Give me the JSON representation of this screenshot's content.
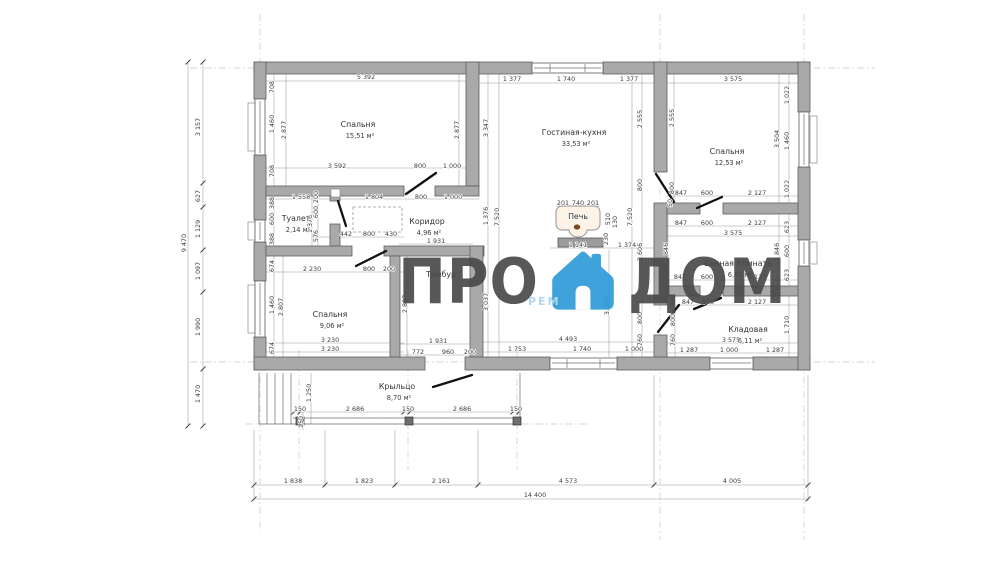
{
  "watermark": {
    "left": "ПРО",
    "right": "ДОМ",
    "sub": "РЕМ"
  },
  "colors": {
    "wall_fill": "#a9a9a9",
    "wall_stroke": "#5e5e5e",
    "accent_blue": "#2f9bd8",
    "text": "#3c3c3c",
    "watermark_grey": "#4a4a4a",
    "stove_dot": "#7a4a21"
  },
  "plan": {
    "rooms": [
      {
        "name": "Спальня",
        "area": "15,51 м²",
        "x": 358,
        "y": 127
      },
      {
        "name": "Гостиная-кухня",
        "area": "33,53 м²",
        "x": 574,
        "y": 135
      },
      {
        "name": "Спальня",
        "area": "12,53 м²",
        "x": 727,
        "y": 154
      },
      {
        "name": "Туалет",
        "area": "2,14 м²",
        "x": 296,
        "y": 221,
        "fs": 7
      },
      {
        "name": "Коридор",
        "area": "4,96 м²",
        "x": 427,
        "y": 224
      },
      {
        "name": "Тамбур",
        "area": "",
        "x": 441,
        "y": 277,
        "fs": 6.6,
        "muted": true
      },
      {
        "name": "Ванная Комната",
        "area": "6,60 м²",
        "x": 738,
        "y": 266
      },
      {
        "name": "Спальня",
        "area": "9,06 м²",
        "x": 330,
        "y": 317
      },
      {
        "name": "Кладовая",
        "area": "6,11 м²",
        "x": 748,
        "y": 332
      },
      {
        "name": "Крыльцо",
        "area": "8,70 м²",
        "x": 397,
        "y": 389
      },
      {
        "name": "Печь",
        "area": "",
        "x": 578,
        "y": 219,
        "fs": 6.2
      }
    ],
    "dims_h": [
      [
        "5 392",
        366,
        79
      ],
      [
        "1 377",
        512,
        81
      ],
      [
        "1 740",
        566,
        81
      ],
      [
        "1 377",
        629,
        81
      ],
      [
        "3 575",
        733,
        81
      ],
      [
        "3 592",
        337,
        168
      ],
      [
        "800",
        420,
        168
      ],
      [
        "1 000",
        452,
        168
      ],
      [
        "1 558",
        301,
        199
      ],
      [
        "1 804",
        374,
        199
      ],
      [
        "800",
        421,
        199
      ],
      [
        "1 000",
        453,
        199
      ],
      [
        "442",
        346,
        236
      ],
      [
        "800",
        369,
        236
      ],
      [
        "430",
        391,
        236
      ],
      [
        "1 931",
        436,
        243
      ],
      [
        "201",
        563,
        205
      ],
      [
        "740",
        578,
        205
      ],
      [
        "201",
        593,
        205
      ],
      [
        "1 141",
        578,
        247
      ],
      [
        "1 374",
        627,
        247
      ],
      [
        "2 230",
        312,
        271
      ],
      [
        "800",
        369,
        271
      ],
      [
        "200",
        389,
        271
      ],
      [
        "847",
        681,
        195
      ],
      [
        "600",
        707,
        195
      ],
      [
        "2 127",
        757,
        195
      ],
      [
        "847",
        681,
        225
      ],
      [
        "600",
        707,
        225
      ],
      [
        "2 127",
        757,
        225
      ],
      [
        "3 575",
        733,
        235
      ],
      [
        "847",
        680,
        279
      ],
      [
        "600",
        707,
        279
      ],
      [
        "2 127",
        757,
        279
      ],
      [
        "847",
        688,
        304
      ],
      [
        "600",
        708,
        304
      ],
      [
        "2 127",
        757,
        304
      ],
      [
        "4 493",
        568,
        341
      ],
      [
        "3 230",
        330,
        342
      ],
      [
        "3 230",
        330,
        351
      ],
      [
        "1 931",
        438,
        343
      ],
      [
        "772",
        418,
        354
      ],
      [
        "960",
        448,
        354
      ],
      [
        "200",
        470,
        354
      ],
      [
        "3 575",
        731,
        342
      ],
      [
        "1 287",
        689,
        352
      ],
      [
        "1 000",
        729,
        352
      ],
      [
        "1 287",
        775,
        352
      ],
      [
        "1 753",
        517,
        351
      ],
      [
        "1 740",
        582,
        351
      ],
      [
        "1 000",
        634,
        351
      ],
      [
        "150",
        300,
        411
      ],
      [
        "2 686",
        355,
        411
      ],
      [
        "150",
        408,
        411
      ],
      [
        "2 686",
        462,
        411
      ],
      [
        "150",
        516,
        411
      ],
      [
        "1 838",
        293,
        483
      ],
      [
        "1 823",
        364,
        483
      ],
      [
        "2 161",
        441,
        483
      ],
      [
        "4 573",
        568,
        483
      ],
      [
        "4 005",
        732,
        483
      ],
      [
        "14 400",
        535,
        497
      ]
    ],
    "dims_v": [
      [
        "9 470",
        186,
        243
      ],
      [
        "3 157",
        200,
        127
      ],
      [
        "627",
        200,
        196
      ],
      [
        "1 129",
        200,
        229
      ],
      [
        "1 097",
        200,
        271
      ],
      [
        "1 990",
        200,
        327
      ],
      [
        "1 470",
        200,
        394
      ],
      [
        "708",
        274,
        87
      ],
      [
        "1 460",
        274,
        124
      ],
      [
        "708",
        274,
        171
      ],
      [
        "2 877",
        286,
        130
      ],
      [
        "2 877",
        459,
        130
      ],
      [
        "3 347",
        488,
        128
      ],
      [
        "388",
        274,
        203
      ],
      [
        "600",
        274,
        219
      ],
      [
        "388",
        274,
        239
      ],
      [
        "200",
        318,
        197
      ],
      [
        "600",
        318,
        212
      ],
      [
        "576",
        318,
        236
      ],
      [
        "1 376",
        312,
        224
      ],
      [
        "674",
        274,
        266
      ],
      [
        "1 460",
        274,
        305
      ],
      [
        "674",
        274,
        348
      ],
      [
        "2 807",
        283,
        307
      ],
      [
        "2 807",
        407,
        304
      ],
      [
        "1 376",
        488,
        216
      ],
      [
        "7 520",
        499,
        217
      ],
      [
        "3 037",
        488,
        302
      ],
      [
        "2 555",
        642,
        119
      ],
      [
        "800",
        642,
        185
      ],
      [
        "7 520",
        632,
        217
      ],
      [
        "2 606",
        642,
        252
      ],
      [
        "800",
        642,
        318
      ],
      [
        "760",
        642,
        340
      ],
      [
        "3 066",
        609,
        306
      ],
      [
        "510",
        610,
        219
      ],
      [
        "130",
        617,
        222
      ],
      [
        "230",
        608,
        239
      ],
      [
        "2 555",
        674,
        118
      ],
      [
        "800",
        674,
        188
      ],
      [
        "50",
        672,
        203
      ],
      [
        "1 846",
        668,
        252
      ],
      [
        "50",
        675,
        301
      ],
      [
        "800",
        675,
        320
      ],
      [
        "760",
        675,
        340
      ],
      [
        "1 022",
        789,
        95
      ],
      [
        "3 504",
        779,
        139
      ],
      [
        "1 460",
        789,
        141
      ],
      [
        "1 022",
        789,
        189
      ],
      [
        "623",
        789,
        227
      ],
      [
        "600",
        789,
        251
      ],
      [
        "623",
        789,
        275
      ],
      [
        "1 846",
        779,
        252
      ],
      [
        "1 710",
        789,
        325
      ],
      [
        "1 250",
        311,
        393
      ],
      [
        "150",
        303,
        422
      ]
    ]
  }
}
